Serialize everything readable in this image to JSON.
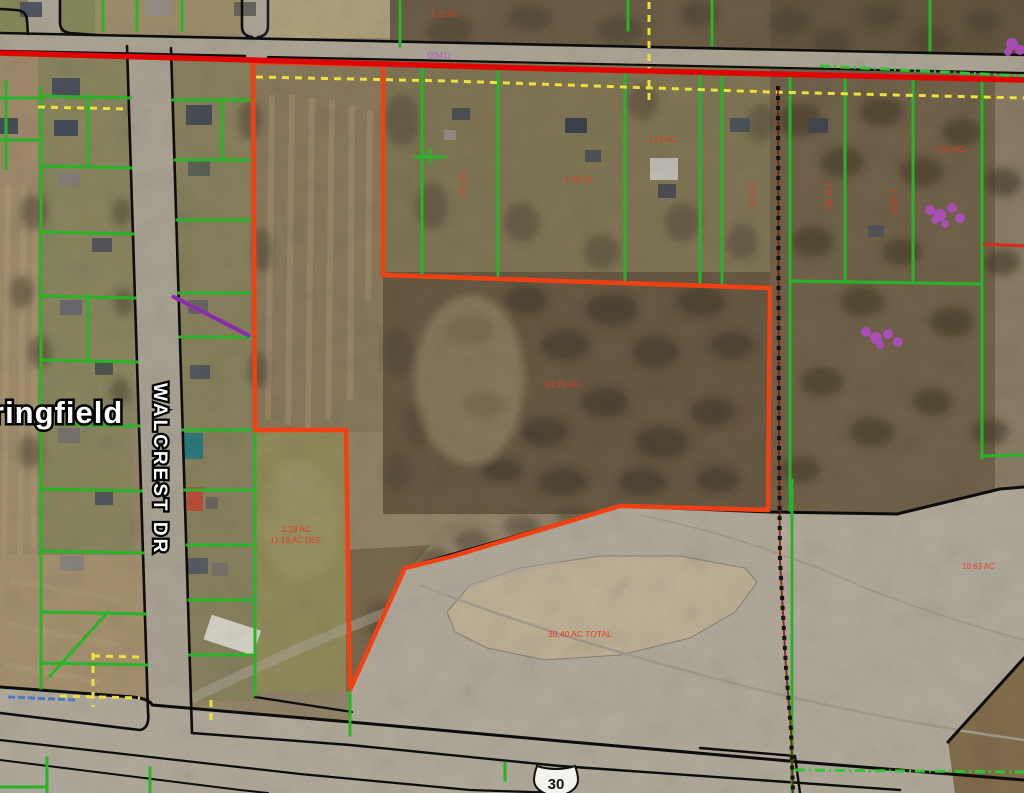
{
  "map": {
    "city_label": "ringfield",
    "street_label": "WALCREST DR",
    "route_shield": "30",
    "utility_label": "(2341)",
    "annotations": [
      {
        "text": "2.11 AC"
      },
      {
        "text": "1.02 AC"
      },
      {
        "text": "1.56 AC"
      },
      {
        "text": "1.21 AC"
      },
      {
        "text": "0.75 AC"
      },
      {
        "text": "1.11 AC"
      },
      {
        "text": "1.48 AC"
      },
      {
        "text": "1.50 AC"
      },
      {
        "text": "16.23 AC"
      },
      {
        "text": "2.29 AC"
      },
      {
        "text": "12.19 AC DEF"
      },
      {
        "text": "30.40 AC TOTAL"
      },
      {
        "text": "10.63 AC"
      }
    ],
    "colors": {
      "selection_red": "#f24012",
      "road_centerline_red": "#e00505",
      "parcel_green": "#28b428",
      "easement_yellow": "#ece23a",
      "section_line_black": "#111111",
      "utility_purple": "#b44cc8",
      "hydro_blue": "#4a78c8"
    }
  }
}
